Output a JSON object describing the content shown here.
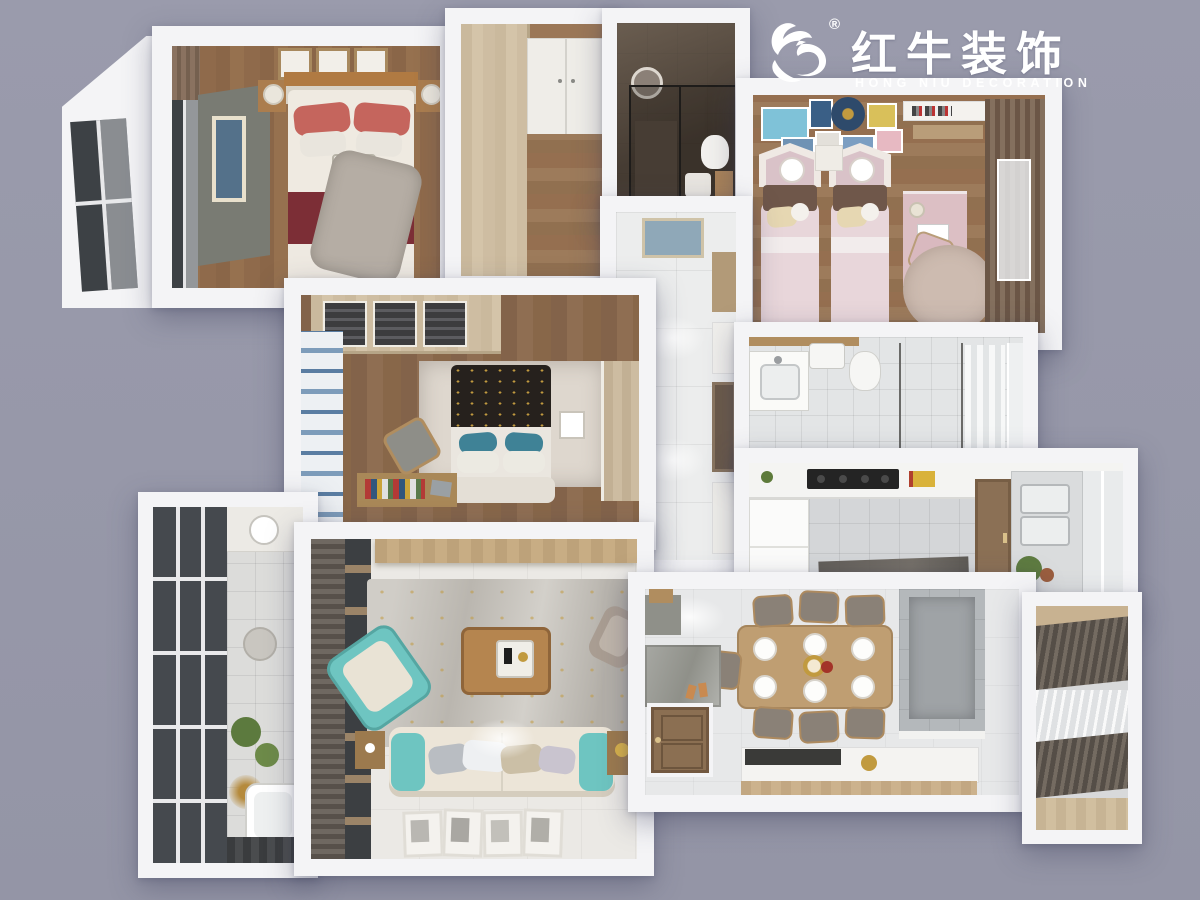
{
  "canvas": {
    "width": 1200,
    "height": 900
  },
  "logo": {
    "registered": "®",
    "brand_cn": "红牛装饰",
    "brand_en": "HONG NIU DECORATION",
    "icon": "bull-swoosh-icon",
    "color": "#ffffff"
  },
  "palette": {
    "background": "#9a9bac",
    "wall": "#f4f4f6",
    "wood_floor": "#96714f",
    "wood_light": "#cfbc9f",
    "wood_medium": "#ab7d4e",
    "dark_glass": "#3e4246",
    "dark_bath": "#4e443b",
    "teal": "#6ec5c1",
    "red_pillow": "#c5655d",
    "dark_red": "#7c2e36",
    "kids_pink": "#e8d6da",
    "kids_brown": "#6f574a",
    "cream": "#e6d7b2",
    "gray_bench": "#797b73",
    "tile_light": "#eceded",
    "tile_gray": "#d4d6d8",
    "marble_gray": "#b4b8bb",
    "curtain_dark": "#5b534b",
    "blue_stripe": "#7d9cba",
    "gold": "#c19a3f"
  },
  "scene": {
    "type": "3d-top-down-apartment-render",
    "rooms": [
      {
        "id": "bedroom-1",
        "furniture": [
          "double-bed",
          "red-pillows",
          "dark-red-blanket",
          "gray-throw",
          "nightstands",
          "table-lamps",
          "gray-daybed",
          "wall-art-frames",
          "bay-window",
          "curtain"
        ]
      },
      {
        "id": "walk-in-closet",
        "furniture": [
          "wood-wardrobe",
          "white-closet-doors",
          "wood-floor"
        ]
      },
      {
        "id": "ensuite-bathroom",
        "furniture": [
          "glass-shower",
          "round-mirror",
          "toilet",
          "sink"
        ]
      },
      {
        "id": "kids-bedroom",
        "furniture": [
          "twin-bed",
          "twin-bed",
          "hexagon-headboards",
          "wall-art-gallery",
          "pink-desk",
          "desk-chair",
          "wall-shelf",
          "round-rug",
          "brown-curtains",
          "window"
        ]
      },
      {
        "id": "hallway",
        "furniture": [
          "marble-tile-floor",
          "wall-art",
          "niche-shelving",
          "ceiling-lights"
        ]
      },
      {
        "id": "main-bathroom",
        "furniture": [
          "vanity-sink",
          "water-heater",
          "toilet",
          "glass-partition",
          "shower-curtain",
          "window"
        ]
      },
      {
        "id": "kitchen",
        "furniture": [
          "counter",
          "cooktop",
          "fridge",
          "floor-mat",
          "door",
          "double-sink",
          "plant",
          "window"
        ]
      },
      {
        "id": "bedroom-2",
        "furniture": [
          "double-bed",
          "patterned-blanket",
          "teal-pillows",
          "glass-wardrobe",
          "side-wardrobe",
          "striped-curtain",
          "rug",
          "desk-with-books",
          "chair"
        ]
      },
      {
        "id": "balcony-left",
        "furniture": [
          "floor-to-ceiling-window",
          "counter-basin",
          "plants",
          "bathtub",
          "side-table"
        ]
      },
      {
        "id": "living-room",
        "furniture": [
          "teal-armchair",
          "sofa",
          "teal-side-cushions",
          "throw-pillows",
          "coffee-table",
          "tray",
          "area-rug",
          "tv-console",
          "curtain-window-wall",
          "side-tables",
          "taupe-armchair",
          "leaning-picture-frames"
        ]
      },
      {
        "id": "dining-room",
        "furniture": [
          "dining-table",
          "six-chairs",
          "plates",
          "center-dish",
          "marble-feature-wall",
          "sideboard-counter",
          "entry-door",
          "doormat",
          "shoe-bench"
        ]
      },
      {
        "id": "balcony-right",
        "furniture": [
          "dark-drapes",
          "sheer-curtain",
          "wood-sill"
        ]
      }
    ]
  }
}
